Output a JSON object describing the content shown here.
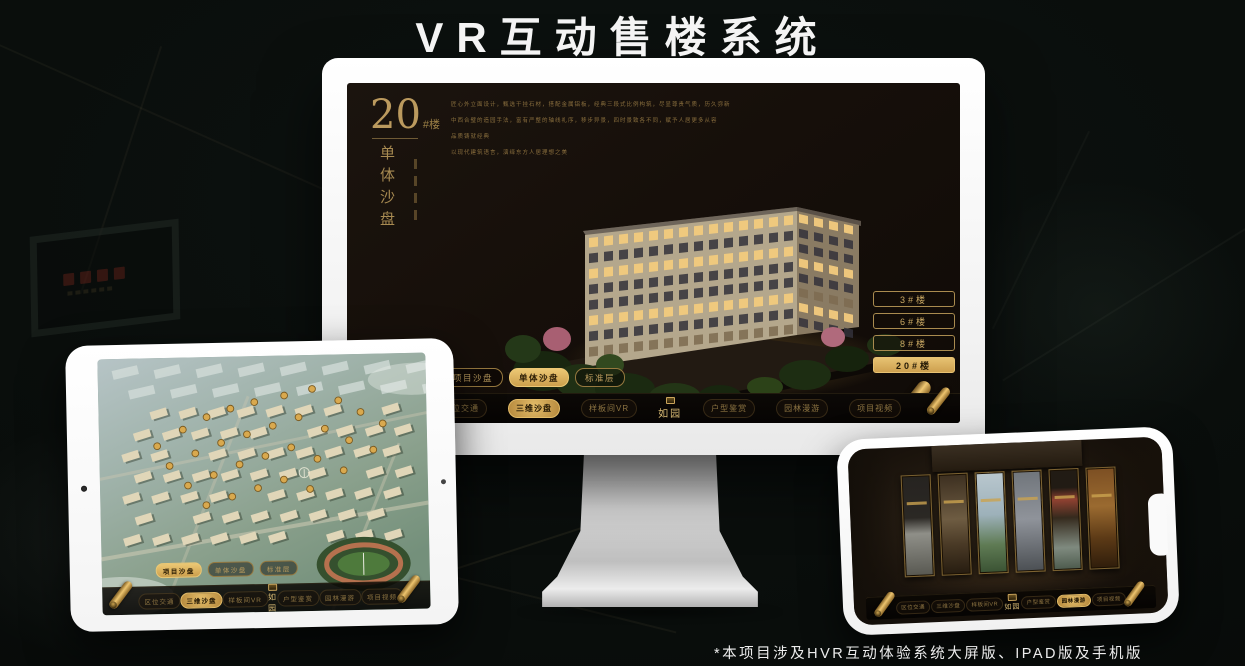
{
  "header": {
    "title": "VR互动售楼系统"
  },
  "footer": {
    "note": "*本项目涉及HVR互动体验系统大屏版、IPAD版及手机版"
  },
  "colors": {
    "gold": "#d9b15f",
    "gold_active": "#e7c272",
    "screen_bg": "#16100b"
  },
  "nav_menu": {
    "logo": "如园",
    "items_left": [
      "区位交通",
      "三维沙盘",
      "样板间VR"
    ],
    "items_right": [
      "户型鉴赏",
      "园林漫游",
      "项目视频"
    ]
  },
  "desktop_app": {
    "headline": {
      "number": "20",
      "suffix": "#楼",
      "title_vertical": "单体沙盘"
    },
    "intro_lines": [
      "匠心外立面设计，甄选干挂石材，搭配金属铝板，经典三段式比例构筑，尽显尊贵气质，历久弥新",
      "中西合璧的造园手法，富有严整的轴线礼序，移步异景，四时景致各不同，赋予人居更多从容",
      "品质铸就经典",
      "以现代建筑语言，演绎东方人居理想之美"
    ],
    "tower_buttons": [
      {
        "label": "3#楼",
        "active": false
      },
      {
        "label": "6#楼",
        "active": false
      },
      {
        "label": "8#楼",
        "active": false
      },
      {
        "label": "20#楼",
        "active": true
      }
    ],
    "tabs": [
      {
        "label": "项目沙盘",
        "active": false
      },
      {
        "label": "单体沙盘",
        "active": true
      },
      {
        "label": "标准层",
        "active": false
      }
    ],
    "active_menu_item": "三维沙盘"
  },
  "ipad_app": {
    "tabs": [
      {
        "label": "项目沙盘",
        "active": true
      },
      {
        "label": "单体沙盘",
        "active": false
      },
      {
        "label": "标准层",
        "active": false
      }
    ],
    "active_menu_item": "三维沙盘"
  },
  "phone_app": {
    "active_menu_item": "园林漫游"
  }
}
